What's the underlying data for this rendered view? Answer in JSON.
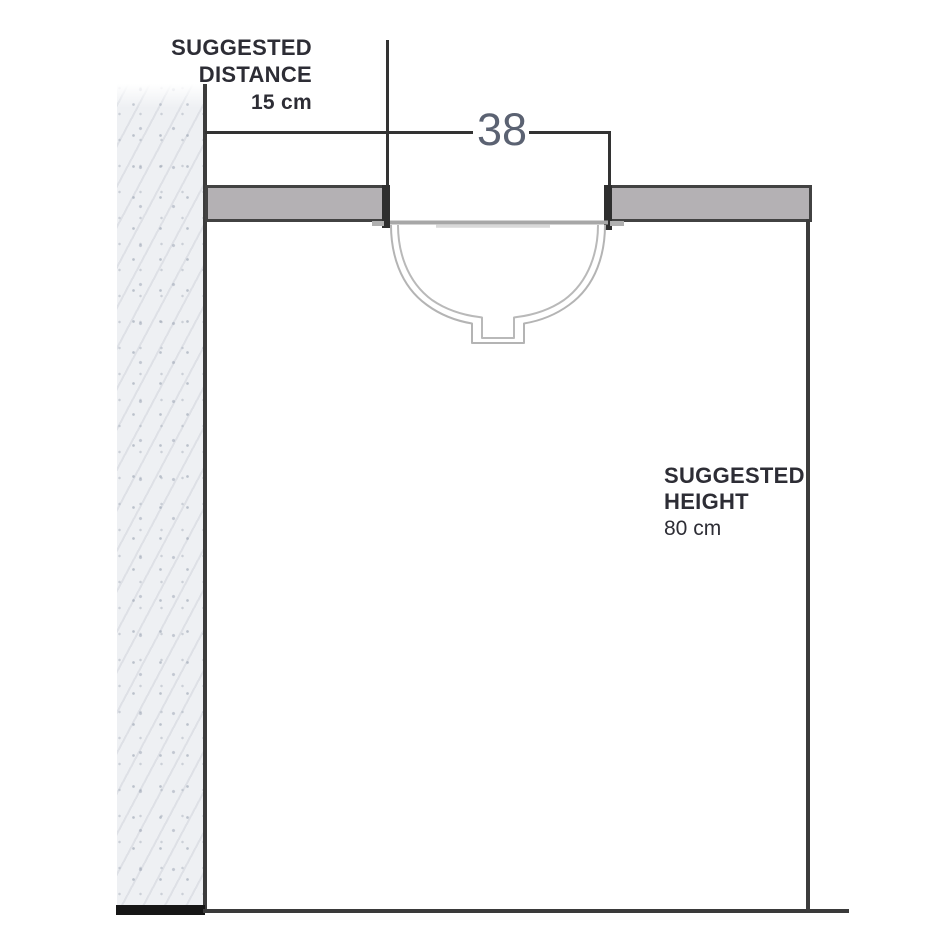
{
  "labels": {
    "distance": {
      "line1": "SUGGESTED",
      "line2": "DISTANCE",
      "value": "15 cm"
    },
    "width": {
      "value": "38"
    },
    "height": {
      "line1": "SUGGESTED",
      "line2": "HEIGHT",
      "value": "80 cm"
    }
  },
  "colors": {
    "background": "#ffffff",
    "outline_dark": "#3a3a3a",
    "counter_fill": "#b4b1b4",
    "basin_line": "#b4b4b4",
    "rim_line": "#a7a7a7",
    "dim_number_text": "#5b6272",
    "label_text": "#2d2d35",
    "wall_fill": "#eef0f3"
  }
}
